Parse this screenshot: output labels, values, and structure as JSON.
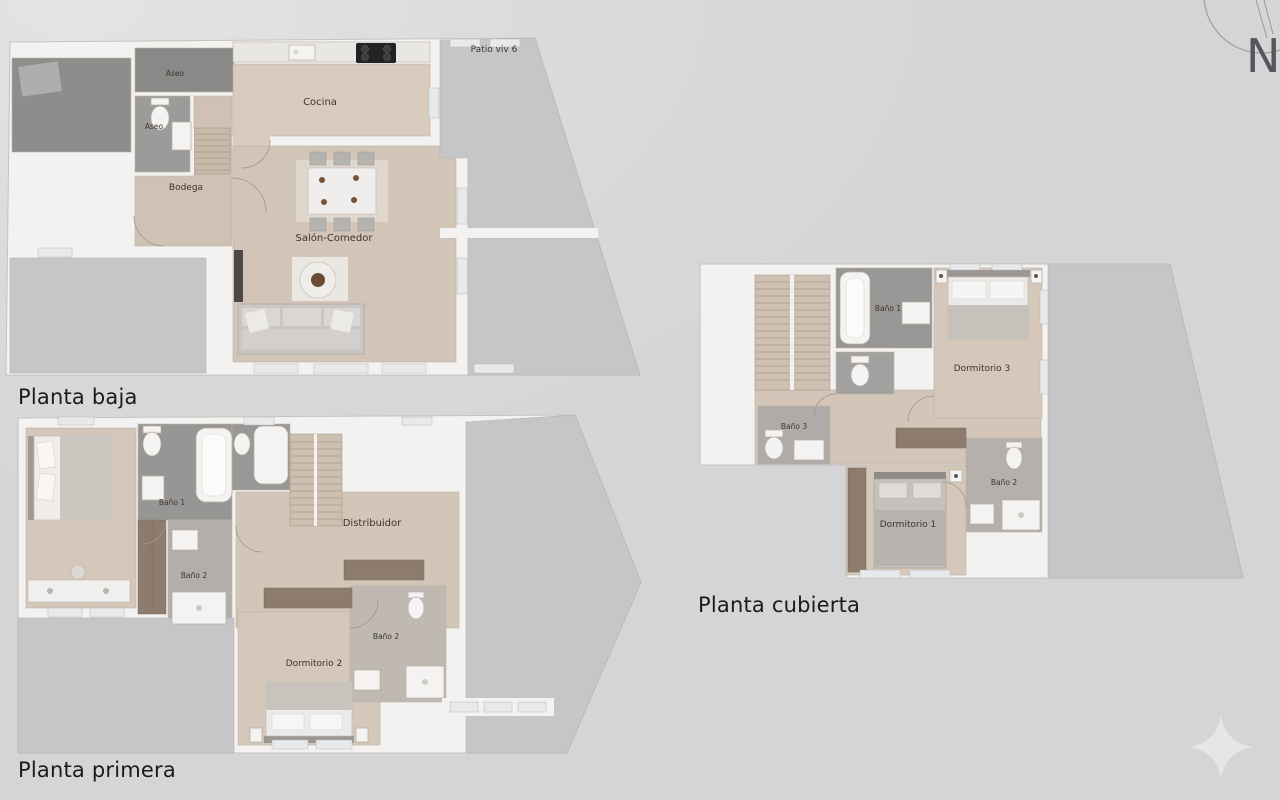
{
  "page": {
    "background": "#dadadc"
  },
  "plans": {
    "baja": {
      "title": "Planta baja",
      "rooms": {
        "aseo_1": "Aseo",
        "aseo_2": "Aseo",
        "bodega": "Bodega",
        "cocina": "Cocina",
        "salon_comedor": "Salón-Comedor",
        "patio": "Patio viv 6"
      }
    },
    "primera": {
      "title": "Planta primera",
      "rooms": {
        "bano_1": "Baño 1",
        "bano_2_left": "Baño 2",
        "distribuidor": "Distribuidor",
        "dormitorio_2": "Dormitorio 2",
        "bano_2_right": "Baño 2"
      }
    },
    "cubierta": {
      "title": "Planta cubierta",
      "rooms": {
        "bano_1": "Baño 1",
        "dormitorio_3": "Dormitorio 3",
        "bano_3": "Baño 3",
        "bano_2": "Baño 2",
        "dormitorio_1": "Dormitorio 1"
      }
    }
  },
  "compass": {
    "label": "N"
  },
  "colors": {
    "background": "#dadadc",
    "wall": "#f3f2f0",
    "wood_floor": "#d4c6b8",
    "patio_gray": "#c6c6c8",
    "dark_patio": "#8e8d8c",
    "bath_gray": "#9a9896",
    "wardrobe_brown": "#8d7c6e",
    "label_text": "#3a352f",
    "title_text": "#1a1a1b"
  }
}
